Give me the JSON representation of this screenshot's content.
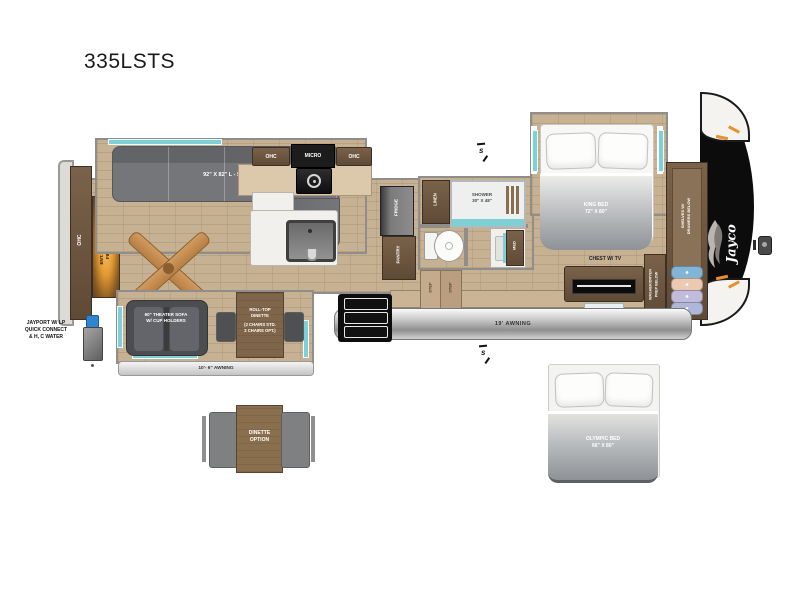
{
  "title": "335LSTS",
  "labels": {
    "rear_ohc": "OHC",
    "ent_center_line1": "ENT. CENTER W/",
    "ent_center_line2": "FIREPLACE",
    "sofa": "92\" X 82\" L - SOFA",
    "ohc_left": "OHC",
    "micro": "MICRO",
    "ohc_right": "OHC",
    "fridge": "FRIDGE",
    "pantry": "PANTRY",
    "linen": "LINEN",
    "shower_line1": "SHOWER",
    "shower_line2": "30\" X 48\"",
    "med": "MED",
    "step": "STEP",
    "king_line1": "KING BED",
    "king_line2": "72\" X 80\"",
    "chest": "CHEST W/ TV",
    "washer_line1": "WASHER/DRYER",
    "washer_line2": "PREP BELOW",
    "shelves_line1": "SHELVES W/",
    "shelves_line2": "DRAWERS BELOW",
    "jayco": "Jayco",
    "theater_line1": "60\" THEATER SOFA",
    "theater_line2": "W/ CUP HOLDERS",
    "rolltop_line1": "ROLL-TOP",
    "rolltop_line2": "DINETTE",
    "rolltop_line3": "(2 CHAIRS STD.",
    "rolltop_line4": "2 CHAIRS OPT.)",
    "awning_main": "19' AWNING",
    "awning_small": "10'- 6\" AWNING",
    "jayport_line1": "JAYPORT W/ LP",
    "jayport_line2": "QUICK CONNECT",
    "jayport_line3": "& H, C WATER",
    "dinette_opt_line1": "DINETTE",
    "dinette_opt_line2": "OPTION",
    "olympic_line1": "OLYMPIC BED",
    "olympic_line2": "66\" X 80\"",
    "speaker": "s"
  },
  "colors": {
    "wood": "#c7b193",
    "accent_teal": "#7fd0d6",
    "cabinet_brown": "#6b5440",
    "sofa_gray": "#74767a",
    "fireplace_glow": "#f2b24a",
    "awning_silver": "#b9b9b9",
    "front_cap": "#0c0c0c"
  }
}
